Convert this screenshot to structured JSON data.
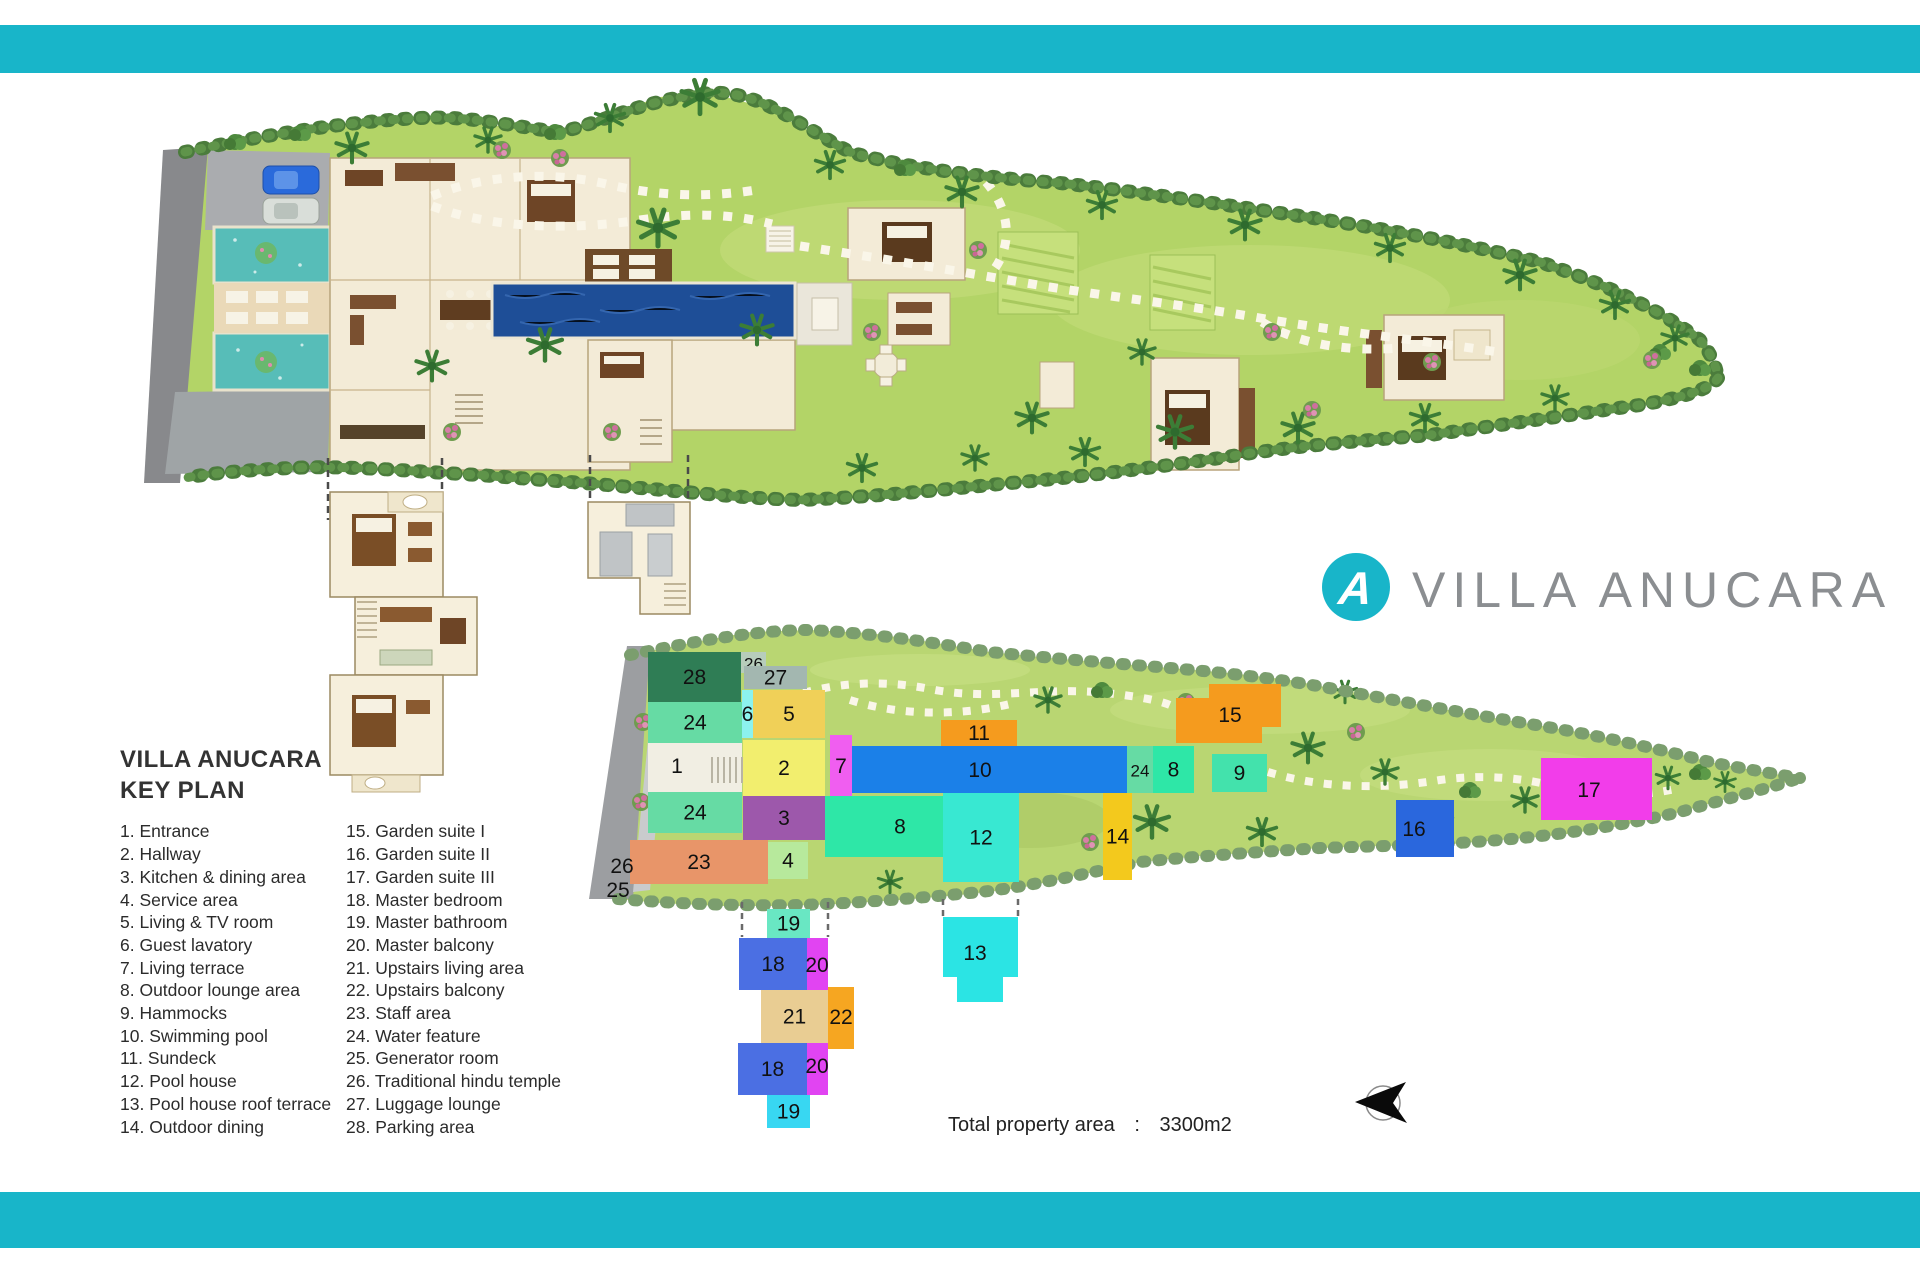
{
  "brand": {
    "name": "VILLA ANUCARA",
    "logo_letter": "A",
    "accent_color": "#18b5c9",
    "logo_text_color": "#8b8e91"
  },
  "legend": {
    "title_line1": "VILLA ANUCARA",
    "title_line2": "KEY PLAN",
    "items_col1": [
      {
        "num": "1.",
        "label": "Entrance"
      },
      {
        "num": "2.",
        "label": "Hallway"
      },
      {
        "num": "3.",
        "label": "Kitchen & dining area"
      },
      {
        "num": "4.",
        "label": "Service area"
      },
      {
        "num": "5.",
        "label": "Living & TV room"
      },
      {
        "num": "6.",
        "label": "Guest lavatory"
      },
      {
        "num": "7.",
        "label": "Living terrace"
      },
      {
        "num": "8.",
        "label": "Outdoor lounge area"
      },
      {
        "num": "9.",
        "label": "Hammocks"
      },
      {
        "num": "10.",
        "label": "Swimming pool"
      },
      {
        "num": "11.",
        "label": "Sundeck"
      },
      {
        "num": "12.",
        "label": "Pool house"
      },
      {
        "num": "13.",
        "label": "Pool house roof terrace"
      },
      {
        "num": "14.",
        "label": "Outdoor dining"
      }
    ],
    "items_col2": [
      {
        "num": "15.",
        "label": "Garden suite I"
      },
      {
        "num": "16.",
        "label": "Garden suite II"
      },
      {
        "num": "17.",
        "label": "Garden suite III"
      },
      {
        "num": "18.",
        "label": "Master bedroom"
      },
      {
        "num": "19.",
        "label": "Master bathroom"
      },
      {
        "num": "20.",
        "label": "Master balcony"
      },
      {
        "num": "21.",
        "label": "Upstairs living area"
      },
      {
        "num": "22.",
        "label": "Upstairs balcony"
      },
      {
        "num": "23.",
        "label": "Staff area"
      },
      {
        "num": "24.",
        "label": "Water feature"
      },
      {
        "num": "25.",
        "label": "Generator room"
      },
      {
        "num": "26.",
        "label": "Traditional hindu temple"
      },
      {
        "num": "27.",
        "label": "Luggage lounge"
      },
      {
        "num": "28.",
        "label": "Parking area"
      }
    ]
  },
  "footer": {
    "total_area_label": "Total property area",
    "separator": ":",
    "total_area_value": "3300m2"
  },
  "keyplan": {
    "number_color": "#111111",
    "blocks": [
      {
        "n": "28",
        "x": 648,
        "y": 652,
        "w": 93,
        "h": 50,
        "c": "#2f7d55"
      },
      {
        "n": "24",
        "x": 648,
        "y": 702,
        "w": 94,
        "h": 41,
        "c": "#66dba4"
      },
      {
        "n": "1",
        "x": 648,
        "y": 743,
        "w": 94,
        "h": 50,
        "c": "#f1eee3",
        "lx": 677,
        "ly": 773
      },
      {
        "n": "24",
        "x": 648,
        "y": 792,
        "w": 94,
        "h": 41,
        "c": "#66dba4"
      },
      {
        "n": "23",
        "x": 630,
        "y": 840,
        "w": 138,
        "h": 44,
        "c": "#e89569"
      },
      {
        "n": "26",
        "x": 741,
        "y": 652,
        "w": 25,
        "h": 21,
        "c": "#b7cdbb",
        "fs": 17
      },
      {
        "n": "27",
        "x": 744,
        "y": 666,
        "w": 63,
        "h": 23,
        "c": "#a3b7b0"
      },
      {
        "n": "6",
        "x": 742,
        "y": 690,
        "w": 11,
        "h": 48,
        "c": "#8cf2ee"
      },
      {
        "n": "5",
        "x": 753,
        "y": 690,
        "w": 72,
        "h": 48,
        "c": "#f0d058"
      },
      {
        "n": "2",
        "x": 743,
        "y": 740,
        "w": 82,
        "h": 56,
        "c": "#f2ee6e"
      },
      {
        "n": "7",
        "x": 830,
        "y": 735,
        "w": 22,
        "h": 62,
        "c": "#f05ef0"
      },
      {
        "n": "3",
        "x": 743,
        "y": 796,
        "w": 82,
        "h": 44,
        "c": "#9d58ab"
      },
      {
        "n": "4",
        "x": 768,
        "y": 842,
        "w": 40,
        "h": 37,
        "c": "#b7e99c"
      },
      {
        "n": "8",
        "x": 825,
        "y": 796,
        "w": 150,
        "h": 61,
        "c": "#2ee7a7"
      },
      {
        "n": "11",
        "x": 941,
        "y": 720,
        "w": 76,
        "h": 26,
        "c": "#f59b1e"
      },
      {
        "n": "10",
        "x": 852,
        "y": 746,
        "w": 280,
        "h": 47,
        "c": "#1b80e8",
        "lx": 980,
        "ly": 777
      },
      {
        "n": "12",
        "x": 943,
        "y": 793,
        "w": 76,
        "h": 89,
        "c": "#38e8d2"
      },
      {
        "n": "24",
        "x": 1127,
        "y": 746,
        "w": 26,
        "h": 47,
        "c": "#66dba4",
        "fs": 17
      },
      {
        "n": "8",
        "x": 1153,
        "y": 746,
        "w": 41,
        "h": 47,
        "c": "#2ee7a7"
      },
      {
        "n": "9",
        "x": 1212,
        "y": 754,
        "w": 55,
        "h": 38,
        "c": "#43e2ac"
      },
      {
        "n": "15",
        "points": "1176,698 1209,698 1209,684 1281,684 1281,727 1262,727 1262,743 1176,743",
        "c": "#f59b1e",
        "lx": 1230,
        "ly": 722
      },
      {
        "n": "14",
        "x": 1103,
        "y": 793,
        "w": 29,
        "h": 87,
        "c": "#f3c91d"
      },
      {
        "n": "16",
        "x": 1396,
        "y": 800,
        "w": 58,
        "h": 57,
        "c": "#2a67dd",
        "lx": 1414,
        "ly": 836
      },
      {
        "n": "17",
        "x": 1541,
        "y": 758,
        "w": 111,
        "h": 62,
        "c": "#f23dea",
        "lx": 1589,
        "ly": 797
      },
      {
        "n": "13",
        "points": "943,917 1018,917 1018,977 1003,977 1003,1002 957,1002 957,977 943,977",
        "c": "#2be4e4",
        "lx": 975,
        "ly": 960
      },
      {
        "n": "19",
        "x": 767,
        "y": 909,
        "w": 43,
        "h": 29,
        "c": "#69e7c3"
      },
      {
        "n": "18",
        "x": 739,
        "y": 938,
        "w": 68,
        "h": 52,
        "c": "#4b6fe3"
      },
      {
        "n": "20",
        "x": 807,
        "y": 938,
        "w": 21,
        "h": 52,
        "c": "#e144f2",
        "lx": 817,
        "ly": 972
      },
      {
        "n": "21",
        "x": 761,
        "y": 990,
        "w": 67,
        "h": 53,
        "c": "#e9cd93"
      },
      {
        "n": "22",
        "x": 828,
        "y": 987,
        "w": 26,
        "h": 62,
        "c": "#f6a621",
        "lx": 841,
        "ly": 1024
      },
      {
        "n": "18",
        "x": 738,
        "y": 1043,
        "w": 69,
        "h": 52,
        "c": "#4b6fe3"
      },
      {
        "n": "20",
        "x": 807,
        "y": 1043,
        "w": 21,
        "h": 52,
        "c": "#e144f2",
        "lx": 817,
        "ly": 1073
      },
      {
        "n": "19",
        "x": 767,
        "y": 1095,
        "w": 43,
        "h": 33,
        "c": "#38d7f2"
      }
    ],
    "floating_labels": [
      {
        "text": "26",
        "x": 622,
        "y": 873
      },
      {
        "text": "25",
        "x": 618,
        "y": 897
      }
    ]
  }
}
